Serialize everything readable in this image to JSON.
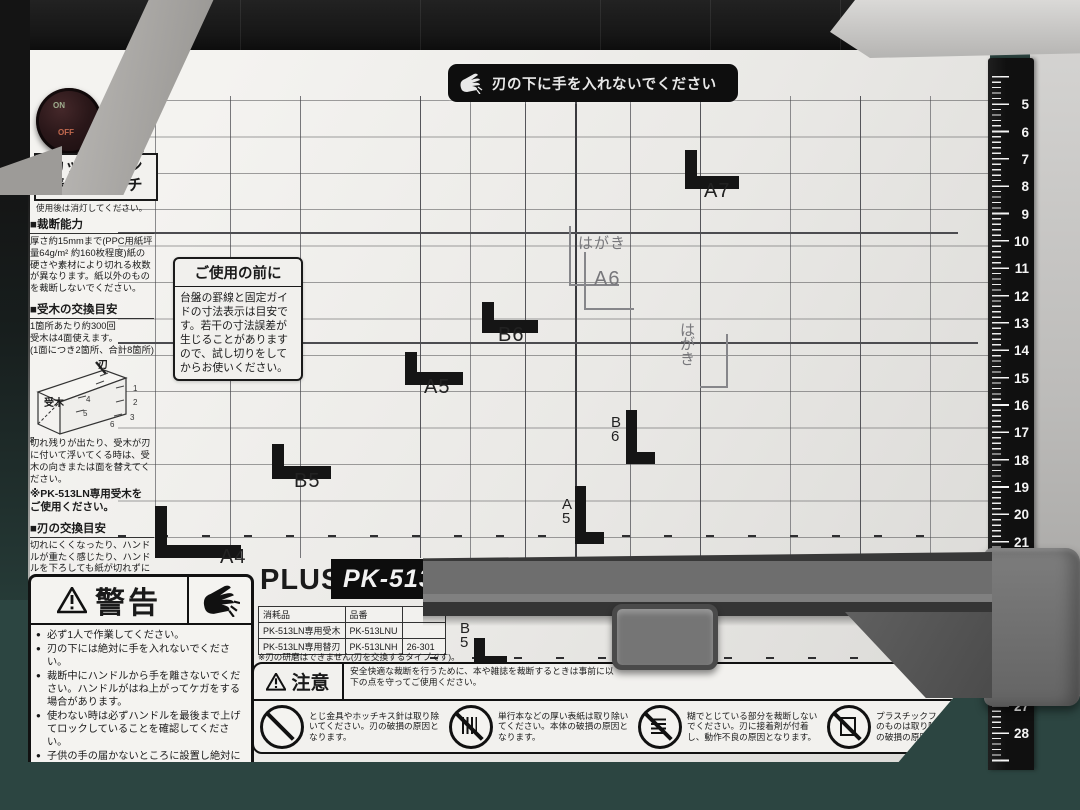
{
  "banner": {
    "text": "刃の下に手を入れないでください"
  },
  "switch": {
    "on": "ON",
    "off": "OFF",
    "label_on": "点灯",
    "label_off": "消灯",
    "box_label": "カットライン\n表示スイッチ",
    "note": "使用後は消灯してください。"
  },
  "sections": {
    "capacity": {
      "title": "■裁断能力",
      "body": "厚さ約15mmまで(PPC用紙坪量64g/m² 約160枚程度)紙の硬さや素材により切れる枚数が異なります。紙以外のものを裁断しないでください。"
    },
    "ukigi": {
      "title": "■受木の交換目安",
      "body": "1箇所あたり約300回\n受木は4面使えます。\n(1面につき2箇所、合計8箇所)",
      "diagram_blade": "刃",
      "diagram_block": "受木",
      "diagram_numbers": [
        "1",
        "2",
        "3",
        "4",
        "5",
        "6",
        "7",
        "8"
      ],
      "note": "切れ残りが出たり、受木が刃に付いて浮いてくる時は、受木の向きまたは面を替えてください。",
      "note2": "※PK-513LN専用受木を\nご使用ください。"
    },
    "blade": {
      "title": "■刃の交換目安",
      "body": "切れにくくなったり、ハンドルが重たく感じたり、ハンドルを下ろしても紙が切れずに本体後部が持ち上がるようになったら、刃を交換してください。\n切れにくくなった状態で無理に裁断し続けると、本体に負担がかかり破損の原因となります。",
      "note": "※PK-513LN専用替刃を\nご使用ください。"
    }
  },
  "before_use": {
    "title": "ご使用の前に",
    "body": "台盤の罫線と固定ガイドの寸法表示は目安です。若干の寸法誤差が生じることがありますので、試し切りをしてからお使いください。"
  },
  "size_marks": {
    "a7": "A7",
    "a6": "A6",
    "hagaki": "はがき",
    "b6": "B6",
    "a5": "A5",
    "b5": "B5",
    "a4": "A4",
    "b6_v": "B\n6",
    "a5_v": "A\n5",
    "b5_v": "B\n5",
    "hagaki_v": "は\nが\nき"
  },
  "warning": {
    "title": "警告",
    "items": [
      "必ず1人で作業してください。",
      "刃の下には絶対に手を入れないでください。",
      "裁断中にハンドルから手を離さないでください。ハンドルがはね上がってケガをする場合があります。",
      "使わない時は必ずハンドルを最後まで上げてロックしていることを確認してください。",
      "子供の手の届かないところに設置し絶対に触れさせないでください。",
      "本体は平らで安定した場所に設置しご使用ください。"
    ]
  },
  "brand": {
    "name": "PLUS",
    "model": "PK-513L"
  },
  "parts_table": {
    "headers": {
      "col1": "消耗品",
      "col2": "品番",
      "col3": ""
    },
    "rows": [
      {
        "name": "PK-513LN専用受木",
        "code": "PK-513LNU",
        "num": ""
      },
      {
        "name": "PK-513LN専用替刃",
        "code": "PK-513LNH",
        "num": "26-301"
      }
    ],
    "note": "※刃の研磨はできません(刃を交換するタイプです)。"
  },
  "caution": {
    "title": "注意",
    "intro": "安全快適な裁断を行うために、本や雑誌を裁断するときは事前に以下の点を守ってご使用ください。",
    "items": [
      {
        "icon": "no-staples-icon",
        "text": "とじ金具やホッチキス針は取り除いてください。刃の破損の原因となります。"
      },
      {
        "icon": "no-thick-cover-icon",
        "text": "単行本などの厚い表紙は取り除いてください。本体の破損の原因となります。"
      },
      {
        "icon": "no-glue-binding-icon",
        "text": "糊でとじている部分を裁断しないでください。刃に接着剤が付着し、動作不良の原因となります。"
      },
      {
        "icon": "no-plastic-film-icon",
        "text": "プラスチックフィルムなど紙以外のものは取り除いてください。刃の破損の原因となります。"
      }
    ]
  },
  "ruler": {
    "numbers": [
      "5",
      "6",
      "7",
      "8",
      "9",
      "10",
      "11",
      "12",
      "13",
      "14",
      "15",
      "16",
      "17",
      "18",
      "19",
      "20",
      "21",
      "22",
      "23",
      "24",
      "25",
      "26",
      "27",
      "28"
    ]
  },
  "colors": {
    "board": "#efeeec",
    "machine_dark": "#1a1a1a",
    "clamp_gray": "#6e6e6e",
    "carpet_teal": "#2c4541",
    "ruler_black": "#121212",
    "banner_black": "#0e0e0e"
  }
}
